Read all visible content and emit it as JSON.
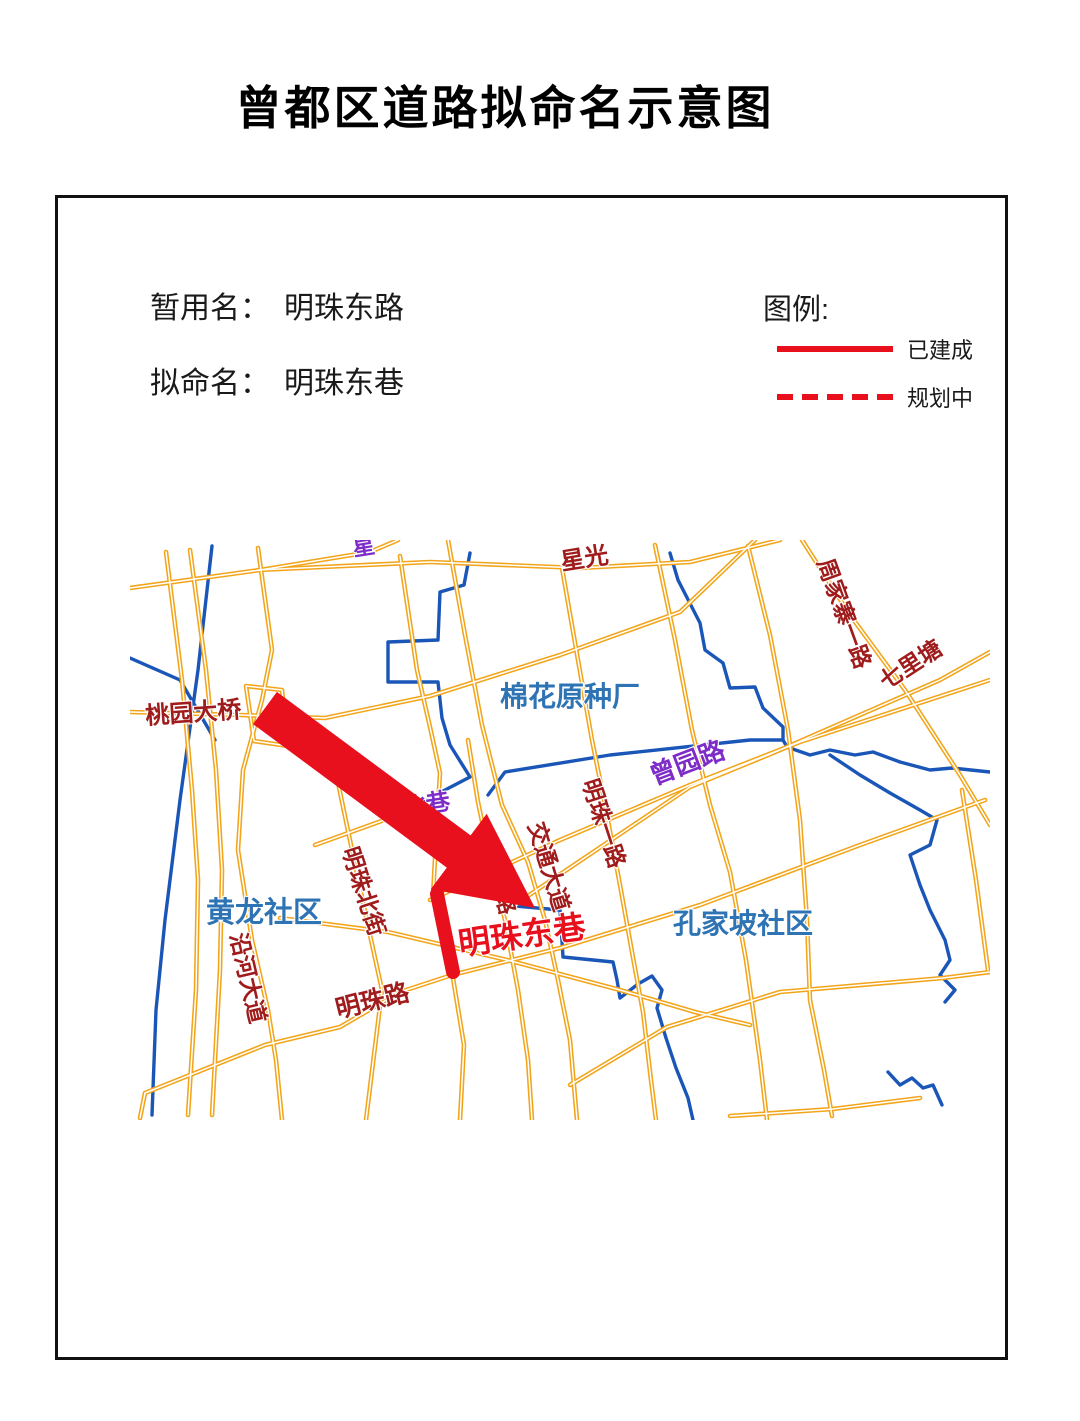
{
  "title": "曾都区道路拟命名示意图",
  "info": {
    "temporary_name_label": "暂用名：",
    "temporary_name": "明珠东路",
    "proposed_name_label": "拟命名：",
    "proposed_name": "明珠东巷"
  },
  "legend": {
    "heading": "图例:",
    "built": "已建成",
    "planned": "规划中",
    "built_style": "solid",
    "planned_style": "dashed"
  },
  "colors": {
    "highlight_red": "#E8101C",
    "road_yellow": "#F2A51A",
    "river_blue": "#1A56B8",
    "label_dark_red": "#A01C1C",
    "label_blue": "#2E74B5",
    "label_purple": "#7D2CC8"
  },
  "map": {
    "highlight_road": "明珠东巷",
    "communities": [
      "黄龙社区",
      "孔家坡社区"
    ],
    "landmark": "棉花原种厂",
    "labels": [
      {
        "id": "taoyuan-bridge",
        "text": "桃园大桥",
        "color": "dark_red",
        "x": 16,
        "y": 184,
        "rot": -4,
        "size": 24
      },
      {
        "id": "xingguang-fragment",
        "text": "星光",
        "color": "dark_red",
        "x": 432,
        "y": 30,
        "rot": -9,
        "size": 24
      },
      {
        "id": "purple-road-fragment",
        "text": "星",
        "color": "purple",
        "x": 224,
        "y": 16,
        "rot": -9,
        "size": 22
      },
      {
        "id": "zhoujiazhai-yilu",
        "text": "周家寨一路",
        "color": "dark_red",
        "x": 687,
        "y": 22,
        "rot": 70,
        "size": 23
      },
      {
        "id": "qilitang",
        "text": "七里塘",
        "color": "dark_red",
        "x": 756,
        "y": 150,
        "rot": -33,
        "size": 23
      },
      {
        "id": "mianhua-seed-factory",
        "text": "棉花原种厂",
        "color": "blue",
        "x": 370,
        "y": 166,
        "rot": 0,
        "size": 28
      },
      {
        "id": "zengyuan-road",
        "text": "曾园路",
        "color": "purple",
        "x": 524,
        "y": 245,
        "rot": -21,
        "size": 26
      },
      {
        "id": "mingzhu-yilu",
        "text": "明珠一路",
        "color": "dark_red",
        "x": 452,
        "y": 242,
        "rot": 72,
        "size": 23
      },
      {
        "id": "jiaotong-avenue",
        "text": "交通大道",
        "color": "dark_red",
        "x": 398,
        "y": 285,
        "rot": 73,
        "size": 23
      },
      {
        "id": "hanmeng-road",
        "text": "汉孟路",
        "color": "dark_red",
        "x": 354,
        "y": 312,
        "rot": 75,
        "size": 22
      },
      {
        "id": "yangbei-lane",
        "text": "杨北巷",
        "color": "purple",
        "x": 250,
        "y": 280,
        "rot": -9,
        "size": 24
      },
      {
        "id": "mingzhu-beijie",
        "text": "明珠北街",
        "color": "dark_red",
        "x": 212,
        "y": 310,
        "rot": 72,
        "size": 23
      },
      {
        "id": "yanhe-avenue",
        "text": "沿河大道",
        "color": "dark_red",
        "x": 100,
        "y": 395,
        "rot": 77,
        "size": 23
      },
      {
        "id": "huanglong-community",
        "text": "黄龙社区",
        "color": "blue",
        "x": 76,
        "y": 382,
        "rot": 0,
        "size": 29
      },
      {
        "id": "mingzhu-road",
        "text": "明珠路",
        "color": "dark_red",
        "x": 208,
        "y": 478,
        "rot": -14,
        "size": 25
      },
      {
        "id": "kongjiapo-community",
        "text": "孔家坡社区",
        "color": "blue",
        "x": 543,
        "y": 393,
        "rot": 0,
        "size": 28
      },
      {
        "id": "mingzhu-dongxiang",
        "text": "明珠东巷",
        "color": "highlight",
        "x": 330,
        "y": 415,
        "rot": -8,
        "size": 32,
        "bold": true
      }
    ]
  }
}
